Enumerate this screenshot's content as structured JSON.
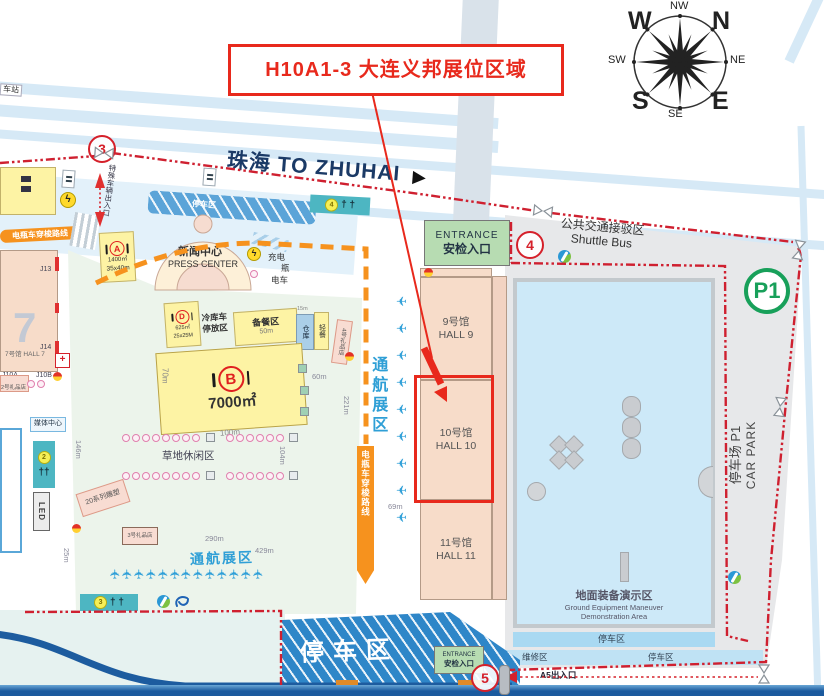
{
  "callout": {
    "text": "H10A1-3  大连义邦展位区域"
  },
  "compass": {
    "w": "W",
    "n": "N",
    "s": "S",
    "e": "E",
    "nw": "NW",
    "ne": "NE",
    "sw": "SW",
    "se": "SE"
  },
  "road": {
    "to_zhuhai": "珠海 TO ZHUHAI",
    "station": "车站"
  },
  "gates": {
    "gate3": "3",
    "gate4": "4",
    "gate5": "5"
  },
  "toilets": {
    "t2": "2",
    "t3": "3",
    "t4": "4"
  },
  "entrance": {
    "en": "ENTRANCE",
    "cn": "安检入口"
  },
  "shuttle_bus": {
    "cn": "公共交通接驳区",
    "en": "Shuttle Bus"
  },
  "car_park": {
    "badge": "P1",
    "cn": "停车场 P1",
    "en": "CAR PARK"
  },
  "halls": {
    "hall7_numeral": "7",
    "hall7": "7号馆 HALL 7",
    "j13": "J13",
    "j14": "J14",
    "j10a": "J10A",
    "j10b": "J10B",
    "hall9_cn": "9号馆",
    "hall9_en": "HALL 9",
    "hall10_cn": "10号馆",
    "hall10_en": "HALL 10",
    "hall11_cn": "11号馆",
    "hall11_en": "HALL 11"
  },
  "press_center": {
    "cn": "新闻中心",
    "en": "PRESS CENTER"
  },
  "helipads": {
    "a_letter": "A",
    "a_area": "1400㎡",
    "a_dim": "35x40m",
    "d_letter": "D",
    "d_area": "625㎡",
    "d_dim": "25x25M",
    "b_letter": "B",
    "b_area": "7000㎡",
    "b_len": "100m",
    "b_wid": "70m"
  },
  "food": {
    "prep": "备餐区",
    "prep_len": "50m",
    "cold_storage": "冷库车停放区",
    "warehouse": "仓库",
    "light_meal": "轻餐",
    "w15": "15m"
  },
  "shops": {
    "gift2": "2号礼品店",
    "gift3": "3号礼品店",
    "gift4": "4号礼品店"
  },
  "leisure": {
    "grass": "草地休闲区",
    "sculpture": "20系列雕塑",
    "media_center": "媒体中心",
    "led": "LED"
  },
  "ga_zone": {
    "vertical": "通航展区",
    "horizontal": "通航展区"
  },
  "routes": {
    "shuttle_pill": "电瓶车穿梭路线",
    "shuttle_banner": "电瓶车穿梭路线",
    "special_vehicle": "特殊车辆出入口",
    "a5": "A5出入口",
    "charge_l1": "充电",
    "charge_l2": "瓶",
    "charge_l3": "电车"
  },
  "parking": {
    "big": "停车区",
    "north_band": "停车区",
    "demo_south": "停车区",
    "repair": "维修区",
    "bottom_band": "停车区"
  },
  "demo_area": {
    "cn": "地面装备演示区",
    "en1": "Ground Equipment Maneuver",
    "en2": "Demonstration Area"
  },
  "measures": {
    "m60": "60m",
    "m69": "69m",
    "m104": "104m",
    "m146": "146m",
    "m221": "221m",
    "m25": "25m",
    "m290": "290m",
    "m429": "429m"
  },
  "icons": {
    "plane": "✈",
    "bolt": "ϟ",
    "cross": "+",
    "arrow_right": "▶",
    "person": "†",
    "left_planes": 9,
    "bottom_planes": 13,
    "umb_row1a": 8,
    "umb_row1b": 6,
    "umb_row2a": 8,
    "umb_row2b": 6
  },
  "colors": {
    "red": "#e8291c",
    "orange": "#f6921e",
    "blue_text": "#2f9fd6",
    "green": "#18a05a",
    "boundary": "#cf2030"
  }
}
